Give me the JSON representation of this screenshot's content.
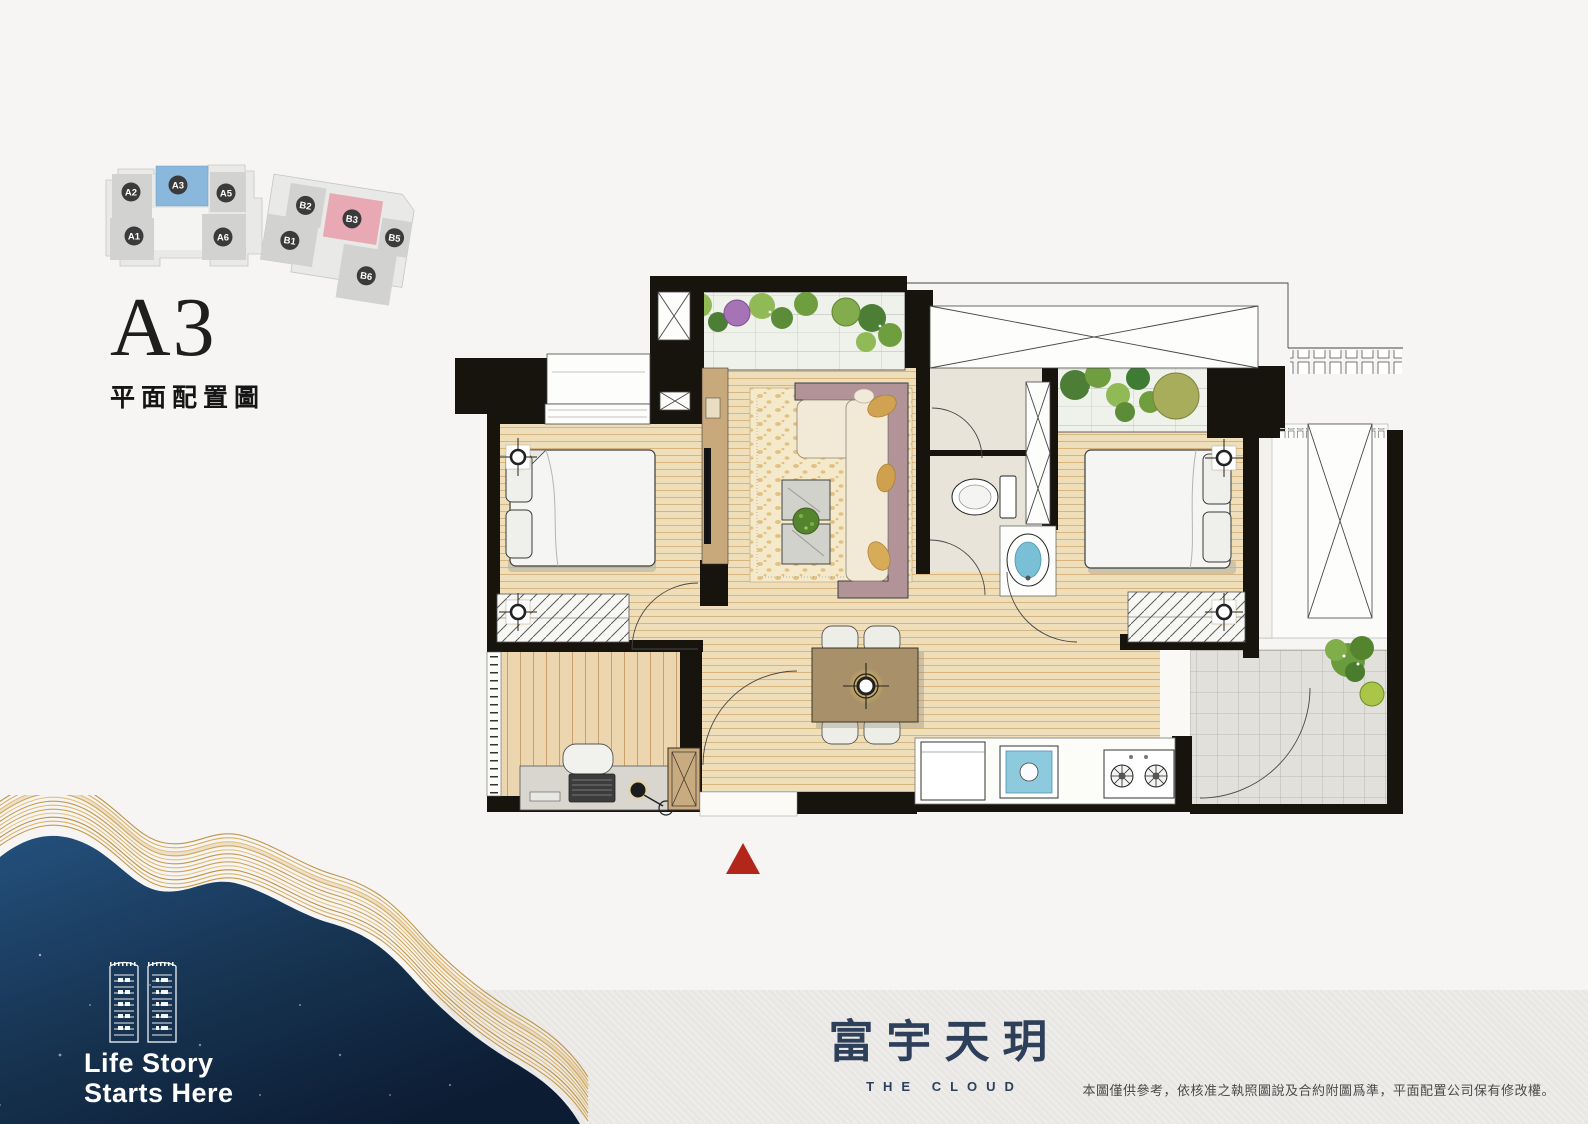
{
  "page": {
    "background": "#f6f5f3",
    "footer_band": "#e9e7e4"
  },
  "keyplan": {
    "units": [
      {
        "id": "A2"
      },
      {
        "id": "A3"
      },
      {
        "id": "A5"
      },
      {
        "id": "A1"
      },
      {
        "id": "A6"
      },
      {
        "id": "B2"
      },
      {
        "id": "B3"
      },
      {
        "id": "B5"
      },
      {
        "id": "B1"
      },
      {
        "id": "B6"
      }
    ],
    "highlighted_unit": "A3",
    "highlight_color": "#8ab8dd",
    "secondary_highlight_unit": "B3",
    "secondary_highlight_color": "#e9a9b4"
  },
  "plan_header": {
    "unit_label": "A3",
    "subtitle": "平面配置圖"
  },
  "floor_plan": {
    "entrance_marker_color": "#b3261a"
  },
  "brand": {
    "logo_cn": "富宇天玥",
    "logo_en": "THE CLOUD",
    "logo_color": "#2e4059"
  },
  "tagline": {
    "line1": "Life Story",
    "line2": "Starts Here"
  },
  "disclaimer": "本圖僅供參考，依核准之執照圖說及合約附圖爲準，平面配置公司保有修改權。",
  "palette": {
    "navy": "#16324f",
    "gold": "#c99a45",
    "wall": "#17130d",
    "wood": "#eedfba",
    "accent_red": "#b3261a"
  }
}
